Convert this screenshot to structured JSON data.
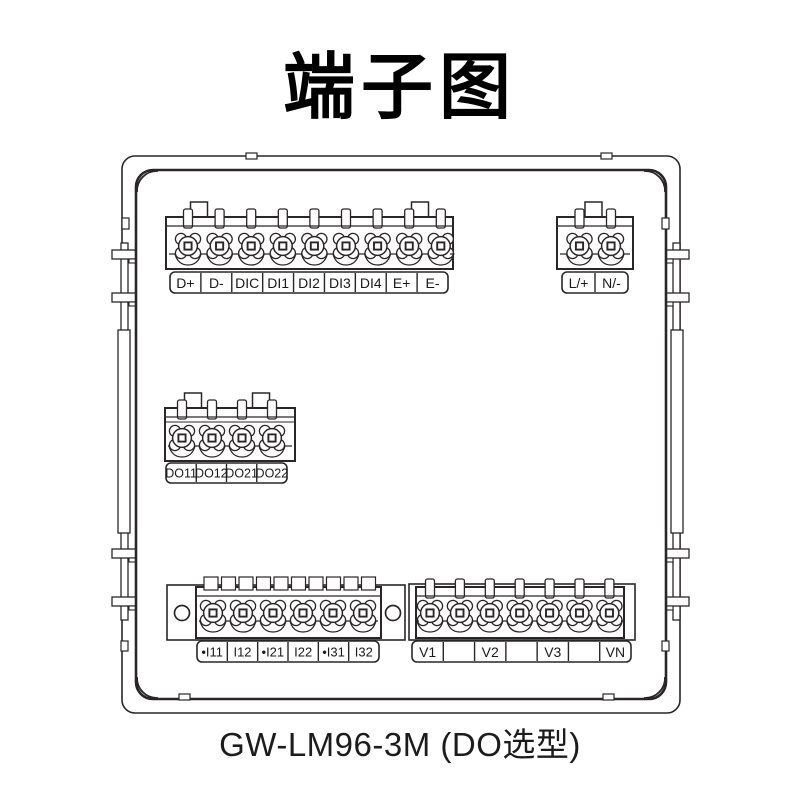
{
  "title": "端子图",
  "caption": "GW-LM96-3M (DO选型)",
  "colors": {
    "line": "#2a2627",
    "text": "#1a1a1a",
    "background": "#ffffff"
  },
  "device": {
    "name": "meter-rear-view",
    "description_labels": []
  },
  "blocks": [
    {
      "id": "comm-di",
      "name": "communication-and-digital-input-terminal-block",
      "labels": [
        "D+",
        "D-",
        "DIC",
        "DI1",
        "DI2",
        "DI3",
        "DI4",
        "E+",
        "E-"
      ]
    },
    {
      "id": "power",
      "name": "power-supply-terminal-block",
      "labels": [
        "L/+",
        "N/-"
      ]
    },
    {
      "id": "do",
      "name": "digital-output-terminal-block",
      "labels": [
        "DO11",
        "DO12",
        "DO21",
        "DO22"
      ]
    },
    {
      "id": "current",
      "name": "current-input-terminal-block",
      "labels": [
        "•I11",
        "I12",
        "•I21",
        "I22",
        "•I31",
        "I32"
      ]
    },
    {
      "id": "voltage",
      "name": "voltage-input-terminal-block",
      "labels": [
        "V1",
        "",
        "V2",
        "",
        "V3",
        "",
        "VN"
      ]
    }
  ]
}
